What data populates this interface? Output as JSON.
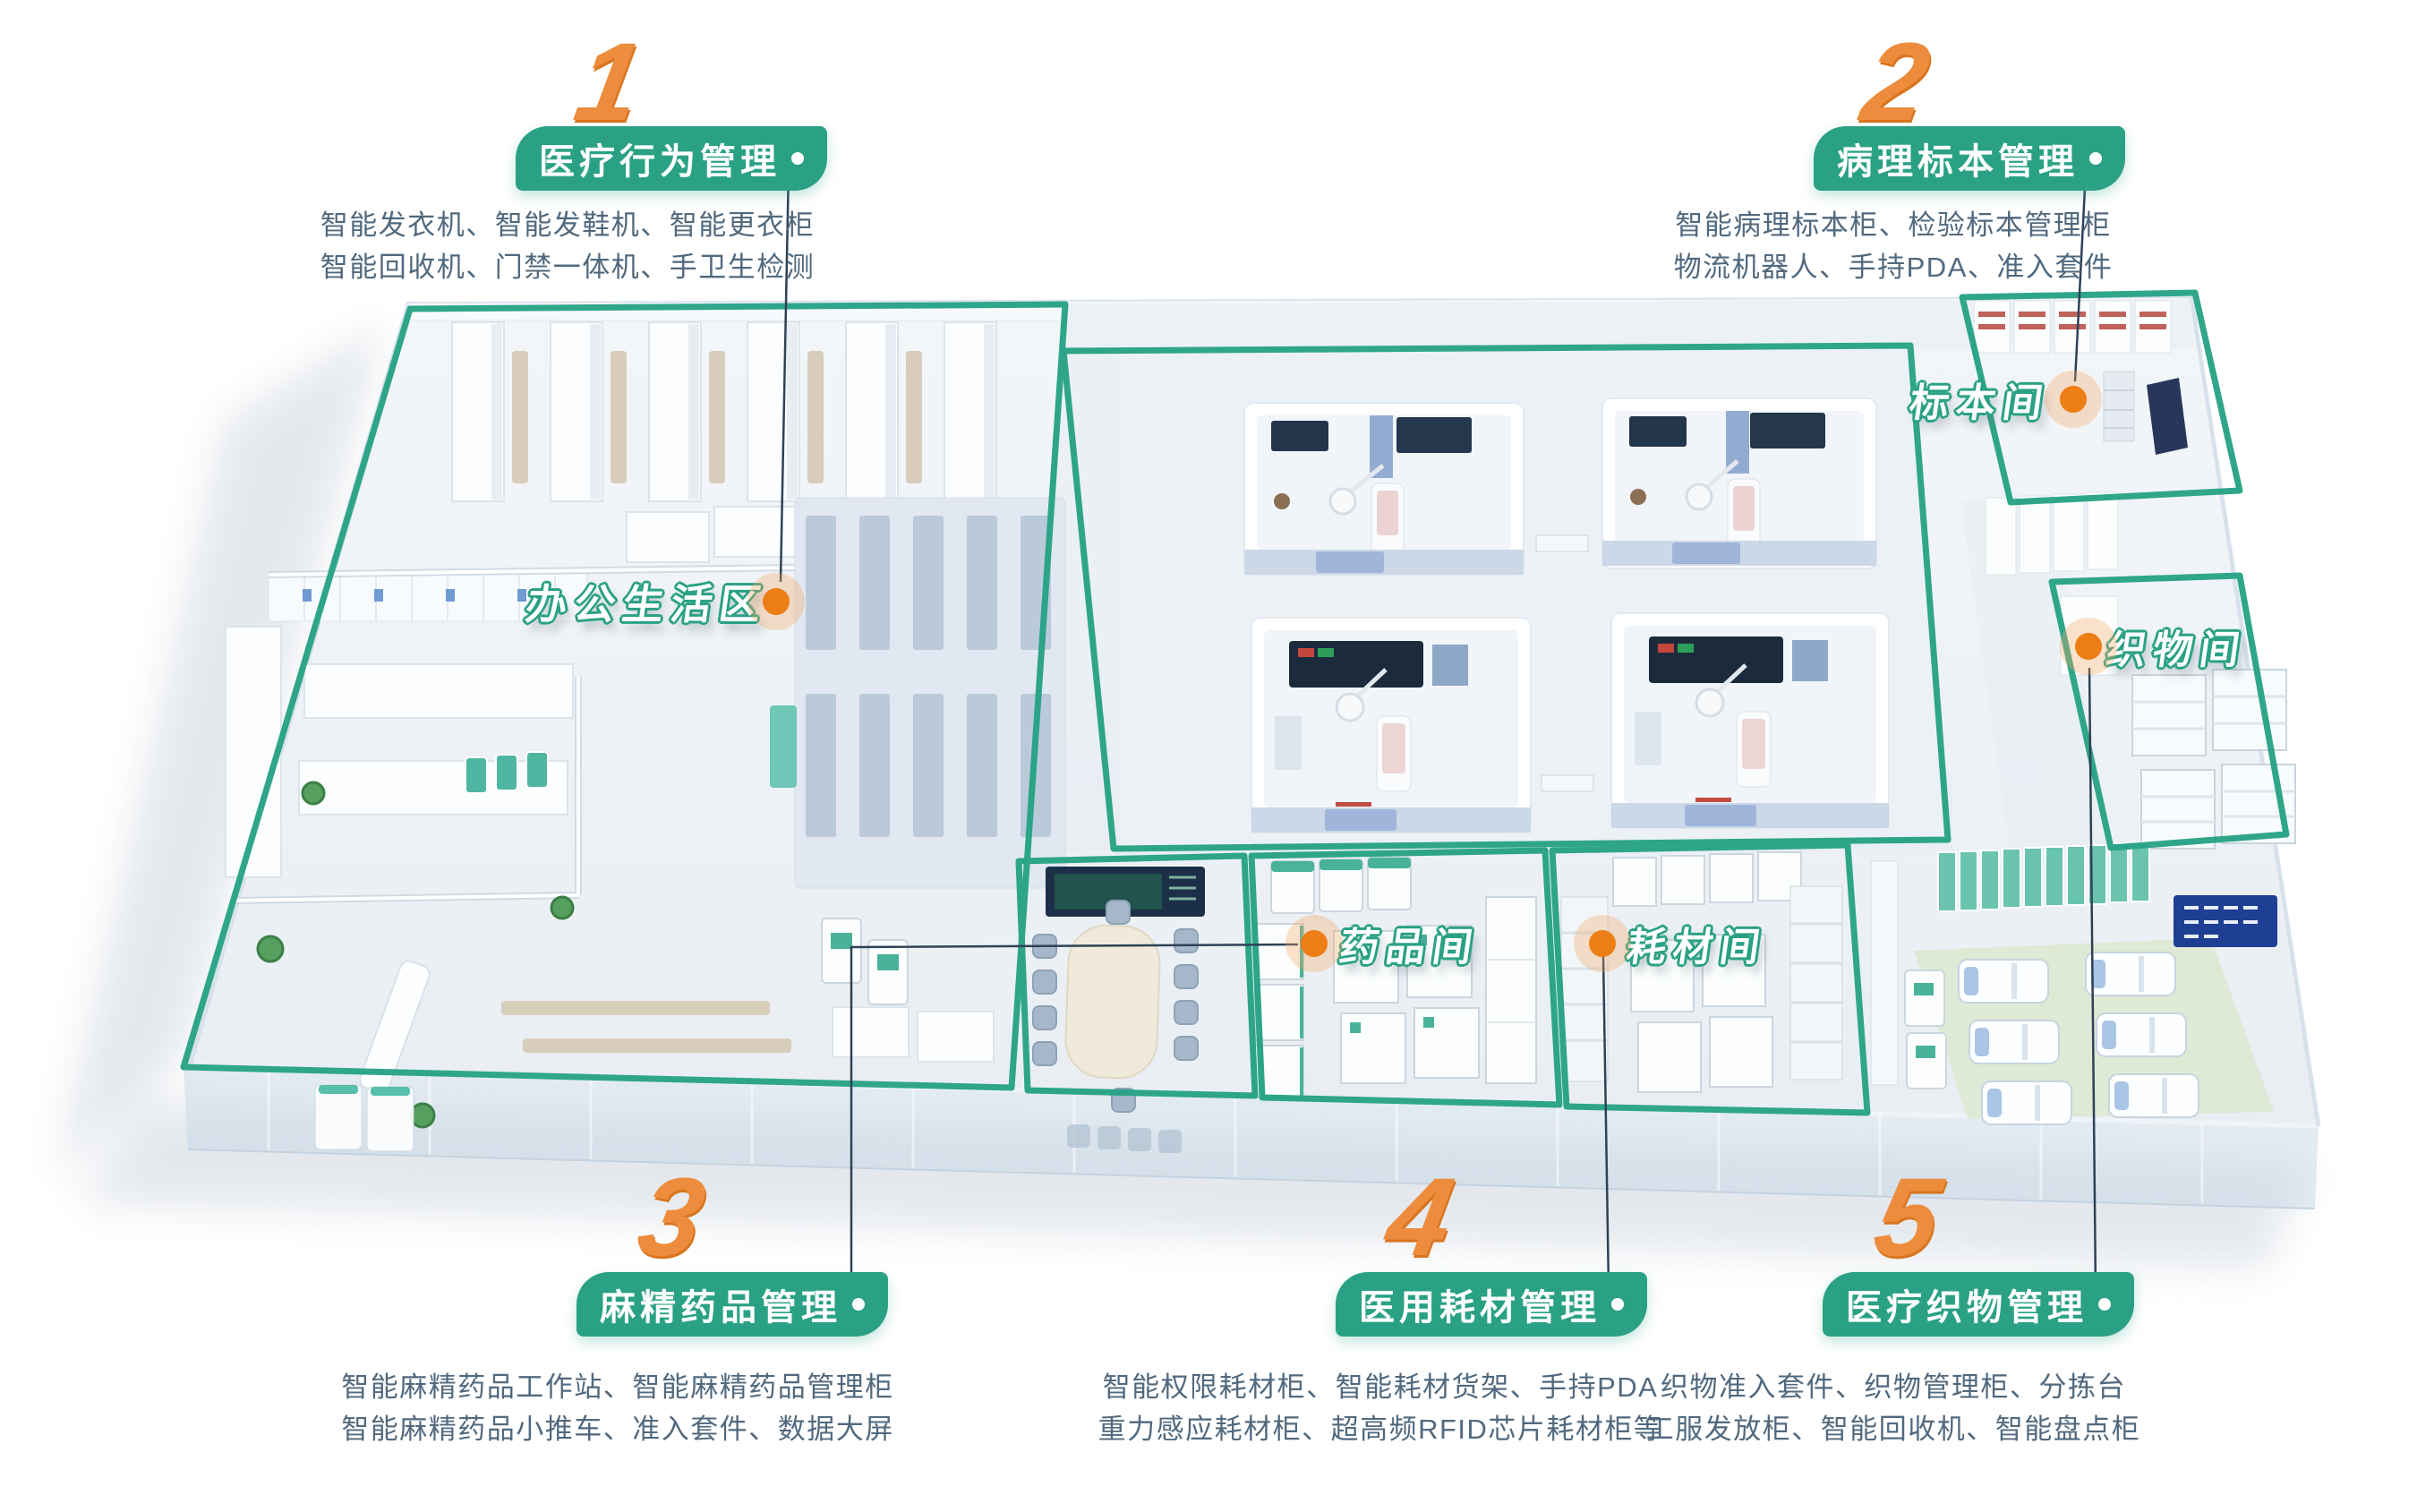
{
  "callouts": [
    {
      "number": "1",
      "title": "医疗行为管理",
      "lines": [
        "智能发衣机、智能发鞋机、智能更衣柜",
        "智能回收机、门禁一体机、手卫生检测"
      ]
    },
    {
      "number": "2",
      "title": "病理标本管理",
      "lines": [
        "智能病理标本柜、检验标本管理柜",
        "物流机器人、手持PDA、准入套件"
      ]
    },
    {
      "number": "3",
      "title": "麻精药品管理",
      "lines": [
        "智能麻精药品工作站、智能麻精药品管理柜",
        "智能麻精药品小推车、准入套件、数据大屏"
      ]
    },
    {
      "number": "4",
      "title": "医用耗材管理",
      "lines": [
        "智能权限耗材柜、智能耗材货架、手持PDA",
        "重力感应耗材柜、超高频RFID芯片耗材柜等"
      ]
    },
    {
      "number": "5",
      "title": "医疗织物管理",
      "lines": [
        "织物准入套件、织物管理柜、分拣台",
        "工服发放柜、智能回收机、智能盘点柜"
      ]
    }
  ],
  "rooms": [
    {
      "id": "office",
      "label": "办公生活区"
    },
    {
      "id": "specimen",
      "label": "标本间"
    },
    {
      "id": "fabric",
      "label": "织物间"
    },
    {
      "id": "drug",
      "label": "药品间"
    },
    {
      "id": "consumable",
      "label": "耗材间"
    }
  ],
  "colors": {
    "zone_green": "#2AA184",
    "numeral_orange": "#EC8C3C",
    "marker_orange": "#ED7D15",
    "marker_halo": "rgba(243,166,96,0.33)",
    "description_text": "#51697E",
    "connector_line": "#2E4257"
  }
}
